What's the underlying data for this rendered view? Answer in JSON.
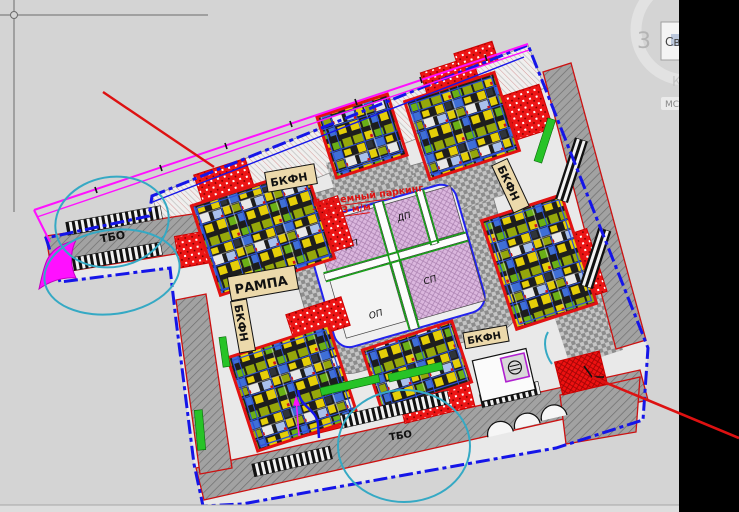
{
  "window": {
    "background": "#d4d4d4",
    "right_black_panel": "#000000",
    "bottom_strip": "#dddddd"
  },
  "drawing": {
    "labels": {
      "bkfn1": "БКФН",
      "bkfn2": "БКФН",
      "bkfn3": "БКФН",
      "bkfn4": "БКФН",
      "rampa": "РАМПА",
      "tbo_left": "ТБО",
      "tbo_bottom": "ТБО",
      "dp_top": "ДП",
      "dp_left": "ДП",
      "sp": "СП",
      "op": "ОП",
      "parking_line1": "Подземный паркинг",
      "parking_line2": "на 73 м/м"
    },
    "colors": {
      "boundary_blue": "#1515e8",
      "redline_magenta": "#ff10ff",
      "leader_red": "#dd1111",
      "turning_cyan": "#35a9c4",
      "playground_lavender": "#dbb7de",
      "road_gray": "#a2a2a2",
      "label_beige": "#ecd9ab",
      "hatch_red": "#ed1515",
      "lawn_green": "#27c327"
    }
  },
  "overlay": {
    "digit": "3",
    "tooltip_text": "Све",
    "glyph": "К",
    "badge": "МС"
  }
}
